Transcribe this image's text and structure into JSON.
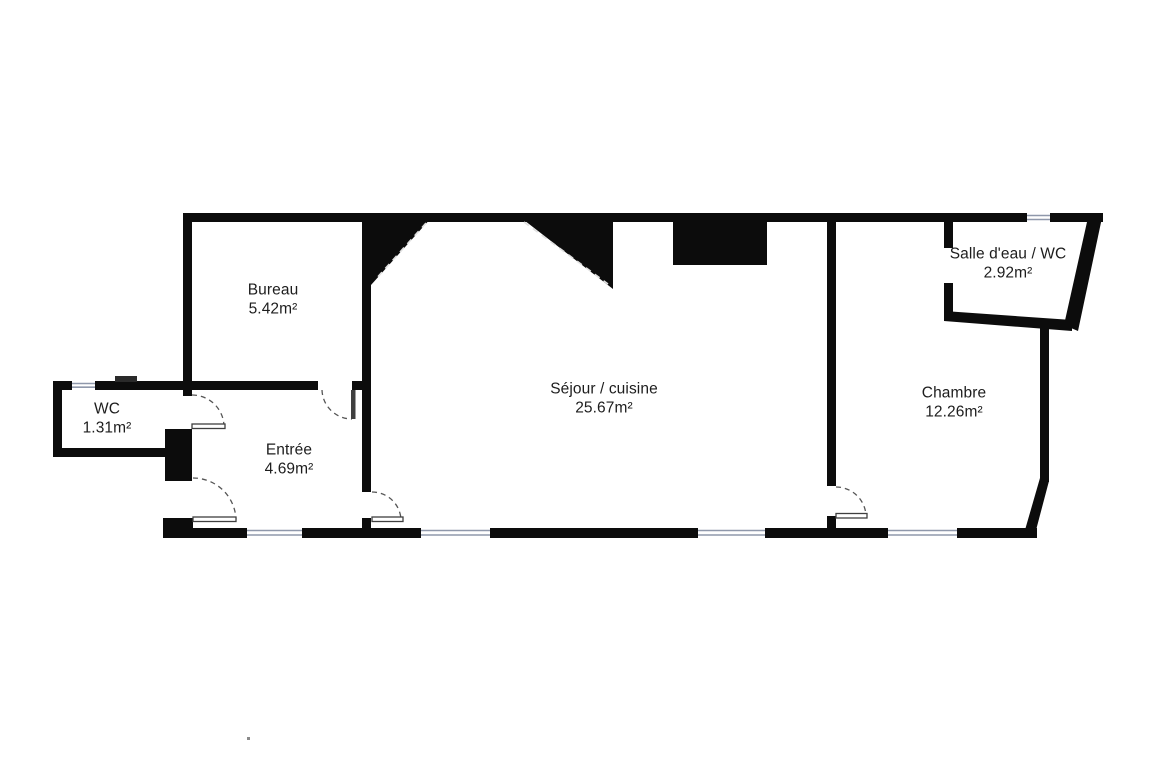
{
  "plan": {
    "type": "floor-plan",
    "rooms": [
      {
        "id": "bureau",
        "name": "Bureau",
        "area": "5.42m²"
      },
      {
        "id": "wc",
        "name": "WC",
        "area": "1.31m²"
      },
      {
        "id": "entree",
        "name": "Entrée",
        "area": "4.69m²"
      },
      {
        "id": "sejour",
        "name": "Séjour / cuisine",
        "area": "25.67m²"
      },
      {
        "id": "chambre",
        "name": "Chambre",
        "area": "12.26m²"
      },
      {
        "id": "salle-deau",
        "name": "Salle d'eau / WC",
        "area": "2.92m²"
      }
    ],
    "colors": {
      "wall": "#0c0c0c",
      "background": "#ffffff",
      "window_line": "#8f98ab",
      "door_line": "#3f3f3f",
      "slope_dash": "#e0e0e0",
      "text": "#1d1d1d"
    }
  }
}
